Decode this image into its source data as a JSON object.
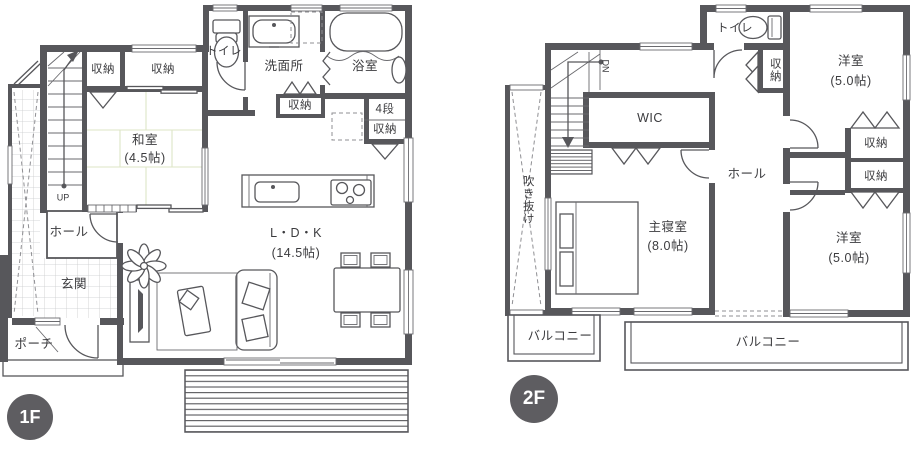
{
  "palette": {
    "wall_color": "#57575b",
    "text_color": "#3b3b3e",
    "badge_background": "#5e5d61",
    "badge_text": "#ffffff",
    "tatami_line_color": "#dde5c6",
    "tile_line_color": "#c9cacc"
  },
  "floor1": {
    "badge": "1F",
    "labels": {
      "closet_a": "収納",
      "closet_b": "収納",
      "toilet": "トイレ",
      "washroom": "洗面所",
      "bath": "浴室",
      "closet_c": "収納",
      "step_storage_top": "4段",
      "step_storage_bottom": "収納",
      "washitsu_name": "和室",
      "washitsu_size": "(4.5帖)",
      "ldk_name": "L・D・K",
      "ldk_size": "(14.5帖)",
      "hall": "ホール",
      "up": "UP",
      "entrance": "玄関",
      "porch": "ポーチ"
    }
  },
  "floor2": {
    "badge": "2F",
    "labels": {
      "toilet": "トイレ",
      "closet_top": "収納",
      "west_room_a_name": "洋室",
      "west_room_a_size": "(5.0帖)",
      "wic": "WIC",
      "dn": "DN",
      "void": "吹き抜け",
      "hall": "ホール",
      "closet_mid_a": "収納",
      "closet_mid_b": "収納",
      "master_name": "主寝室",
      "master_size": "(8.0帖)",
      "west_room_b_name": "洋室",
      "west_room_b_size": "(5.0帖)",
      "balcony_a": "バルコニー",
      "balcony_b": "バルコニー"
    }
  }
}
